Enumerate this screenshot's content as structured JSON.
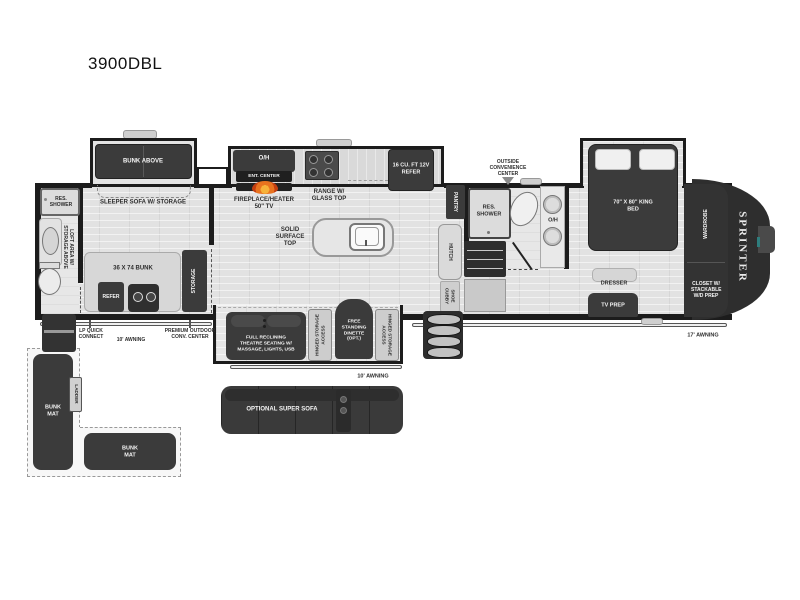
{
  "title": "3900DBL",
  "front_cap": {
    "logo": "SPRINTER"
  },
  "slides": {
    "bunk": {
      "label": "BUNK ABOVE"
    },
    "kitchen": {
      "oh": "O/H",
      "ent_center": "ENT. CENTER",
      "range": "RANGE W/ GLASS TOP",
      "refer": "16 CU. FT 12V REFER"
    },
    "bedroom": {
      "bed": "70\" X 80\" KING BED"
    },
    "living": {
      "theatre": "FULL RECLINING THEATRE SEATING W/ MASSAGE, LIGHTS, USB",
      "hinged_left": "HINGED STORAGE ACCESS",
      "dinette": "FREE STANDING DINETTE (OPT.)",
      "hinged_right": "HINGED STORAGE ACCESS"
    }
  },
  "bunk_room": {
    "sleeper_sofa": "SLEEPER SOFA W/ STORAGE",
    "res_shower": "RES. SHOWER",
    "loft": "LOFT AREA W/ STORAGE ABOVE",
    "bunk": "36 X 74 BUNK",
    "refer": "REFER",
    "storage": "STORAGE"
  },
  "kitchen": {
    "fireplace": "FIREPLACE/HEATER 50\" TV",
    "island": "SOLID SURFACE TOP",
    "hutch": "HUTCH",
    "pantry": "PANTRY",
    "shoe_cubby": "SHOE CUBBY"
  },
  "bathroom": {
    "outside_center": "OUTSIDE CONVENIENCE CENTER",
    "res_shower": "RES. SHOWER",
    "oh": "O/H"
  },
  "bedroom": {
    "dresser": "DRESSER",
    "tv_prep": "TV PREP",
    "wardrobe": "WARDROBE",
    "closet": "CLOSET W/ STACKABLE W/D PREP"
  },
  "exterior": {
    "awning_rear": "10' AWNING",
    "awning_door": "10' AWNING",
    "awning_front": "17' AWNING",
    "lp_quick_connect": "LP QUICK CONNECT",
    "premium_outdoor": "PREMIUM OUTDOOR CONV. CENTER"
  },
  "options": {
    "super_sofa": "OPTIONAL SUPER SOFA",
    "bunk_mat_left": "BUNK MAT",
    "bunk_mat_bottom": "BUNK MAT",
    "ladder": "LADDER"
  },
  "colors": {
    "wall": "#1c1c1c",
    "furniture_dark": "#3b3b3b",
    "floor_light": "#e2e2e2",
    "flame_accent": "#e8731f"
  }
}
